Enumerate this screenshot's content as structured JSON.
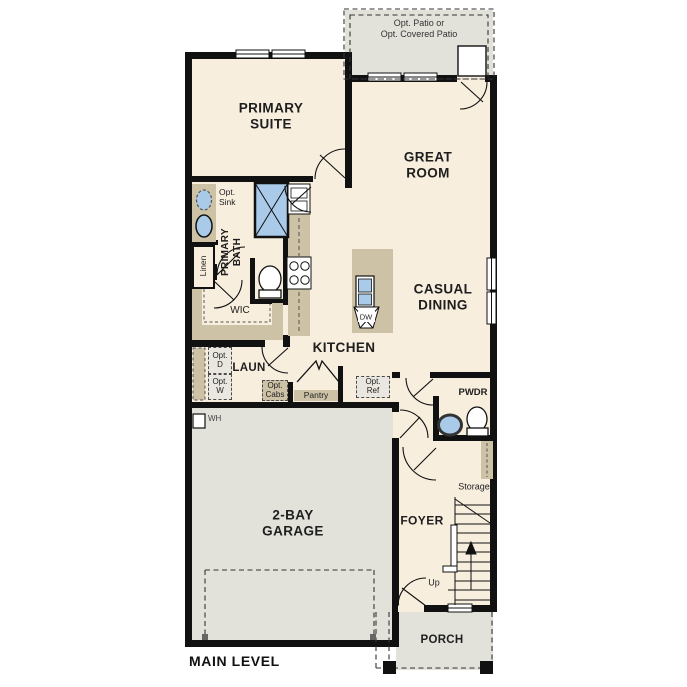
{
  "plan": {
    "title": "MAIN LEVEL",
    "labels": {
      "opt_patio": "Opt. Patio or\nOpt. Covered Patio",
      "primary_suite": "PRIMARY\nSUITE",
      "great_room": "GREAT\nROOM",
      "casual_dining": "CASUAL\nDINING",
      "primary_bath": "PRIMARY\nBATH",
      "opt_sink": "Opt.\nSink",
      "linen": "Linen",
      "wic": "WIC",
      "kitchen": "KITCHEN",
      "dishwasher": "DW",
      "laundry": "LAUN",
      "opt_dryer": "Opt.\nD",
      "opt_washer": "Opt.\nW",
      "opt_cabs": "Opt.\nCabs",
      "pantry": "Pantry",
      "opt_ref": "Opt.\nRef",
      "powder": "PWDR",
      "storage": "Storage",
      "water_heater": "WH",
      "garage": "2-BAY\nGARAGE",
      "foyer": "FOYER",
      "up": "Up",
      "porch": "PORCH"
    },
    "colors": {
      "interior": "#f7eede",
      "outdoor": "#e2e2db",
      "cabinetry": "#cdc1a6",
      "fixture_blue": "#a9cae9",
      "wall": "#111111"
    }
  }
}
